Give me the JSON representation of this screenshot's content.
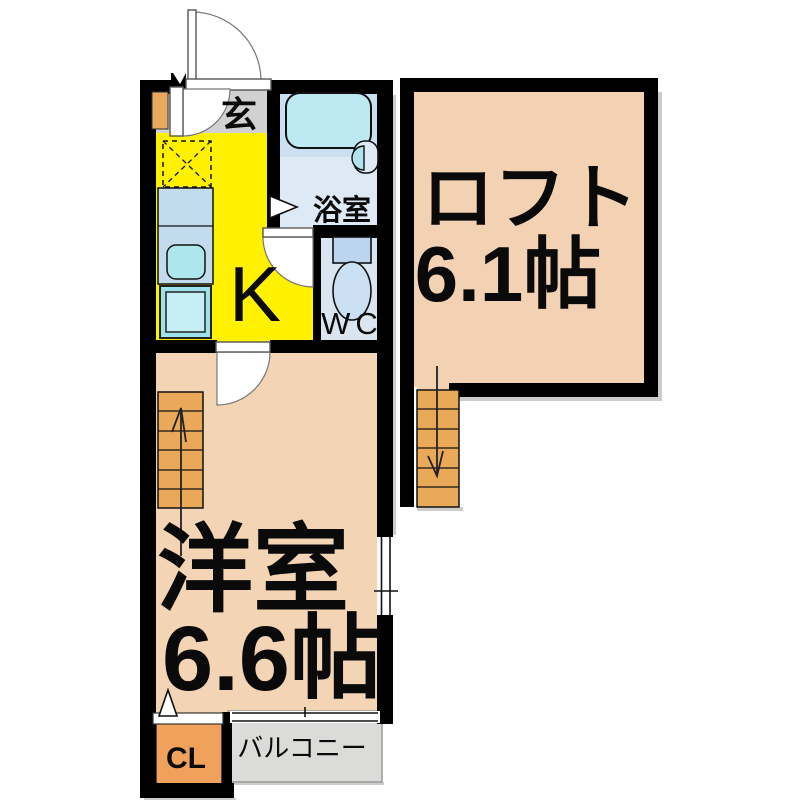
{
  "floor_plan": {
    "rooms": {
      "entrance": {
        "label": "玄"
      },
      "bathroom": {
        "label": "浴室"
      },
      "kitchen": {
        "label": "K"
      },
      "toilet": {
        "label": "WC"
      },
      "western_room": {
        "label": "洋室",
        "size": "6.6帖"
      },
      "loft": {
        "label": "ロフト",
        "size": "6.1帖"
      },
      "closet": {
        "label": "CL"
      },
      "balcony": {
        "label": "バルコニー"
      }
    },
    "colors": {
      "wall": "#000000",
      "kitchen_floor": "#FFF100",
      "entrance_floor": "#D2D1D2",
      "room_floor": "#F3D4B4",
      "loft_floor": "#F2D2B2",
      "stairs": "#E9A958",
      "closet_floor": "#F0A25C",
      "balcony_floor": "#DBDBD9",
      "bath_upper": "#CADFF0",
      "bath_floor": "#DDEAF6",
      "bathtub": "#BFE9F2",
      "wc_floor": "#D9E6EF",
      "toilet_tank": "#BCD4F0",
      "toilet_bowl": "#CCE0F4",
      "counter": "#C2DCEE",
      "sink": "#AEE6EE",
      "washer_pan": "#9EE3EC",
      "washer_pan_inner": "#C6EFF5",
      "basin": "#AFE4EF",
      "door_block": "#E9A95C"
    }
  }
}
